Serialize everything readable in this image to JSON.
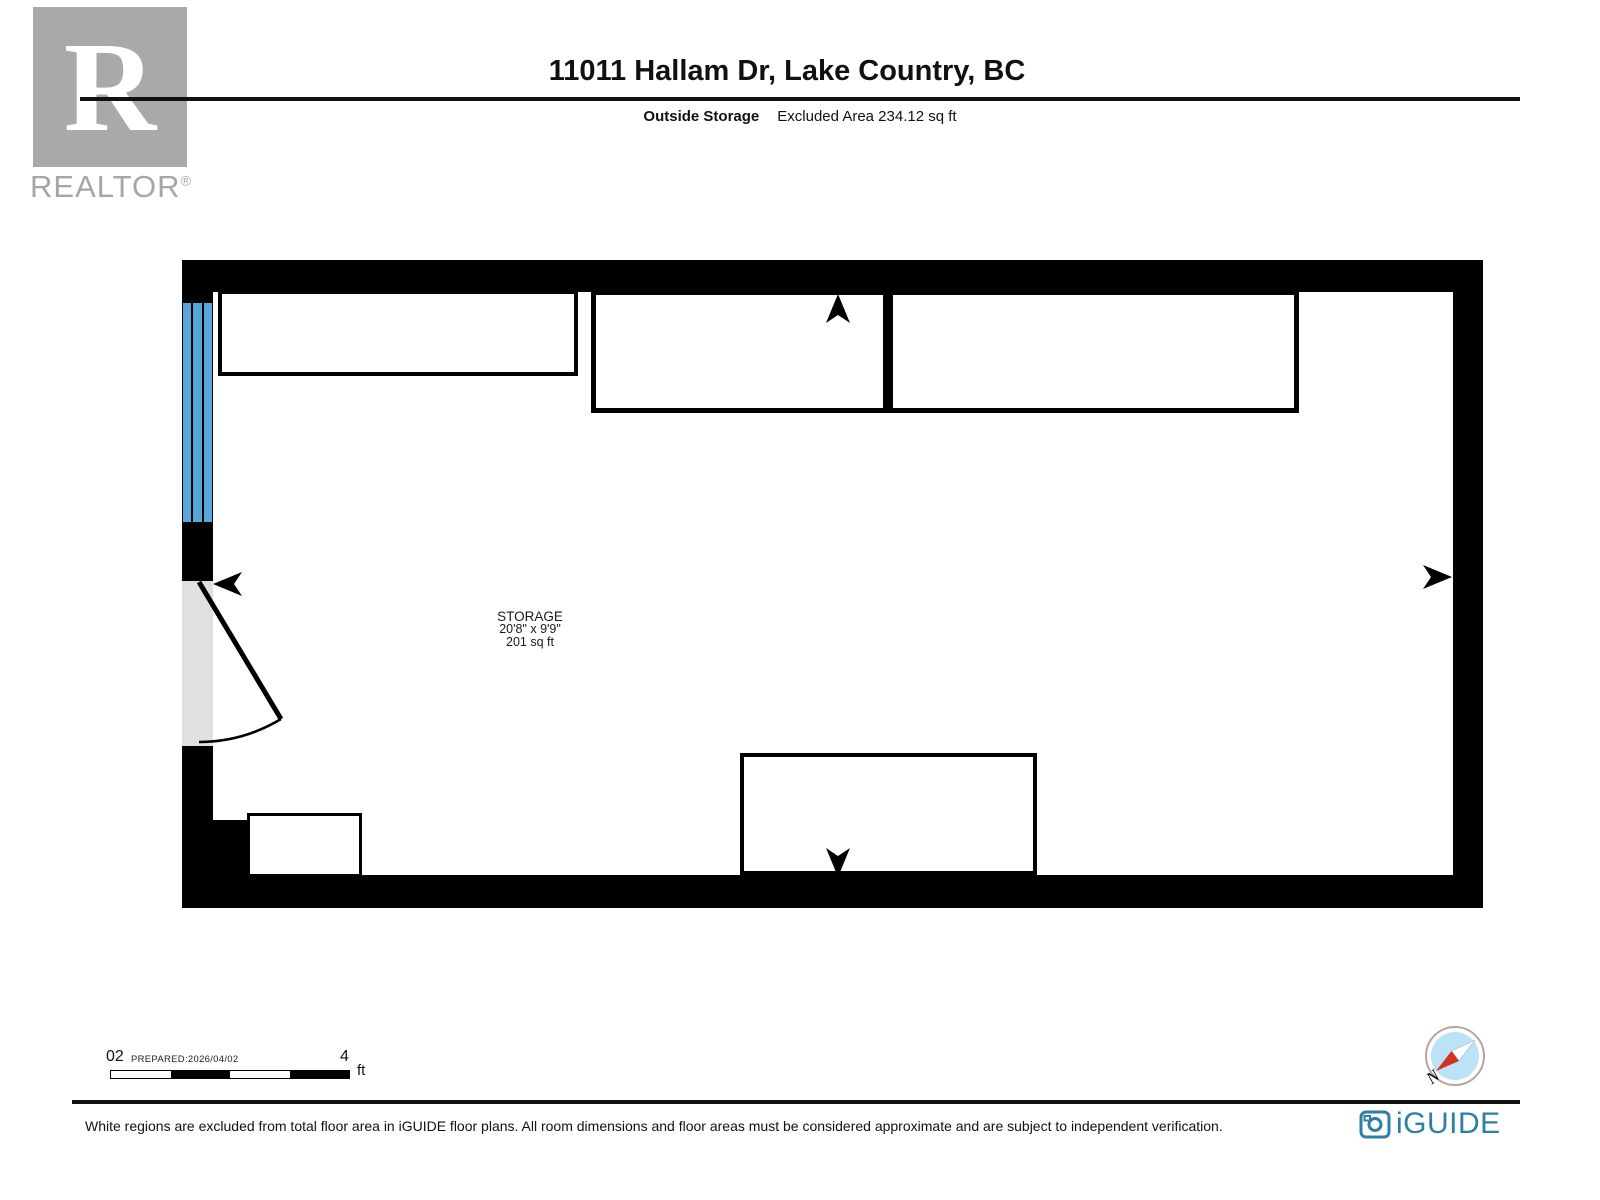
{
  "header": {
    "logo": {
      "letter": "R",
      "wordmark": "REALTOR",
      "registered_mark": "®"
    },
    "title": "11011 Hallam Dr, Lake Country, BC",
    "floor_name": "Outside Storage",
    "excluded_area": "Excluded Area 234.12 sq ft"
  },
  "floorplan": {
    "room": {
      "name": "STORAGE",
      "dimensions": "20'8\" x 9'9\"",
      "area": "201 sq ft"
    }
  },
  "scalebar": {
    "zero_label": "02",
    "prepared_label": "PREPARED:2026/04/02",
    "max_label": "4",
    "unit": "ft"
  },
  "compass": {
    "north_label": "N"
  },
  "branding": {
    "iguide": "iGUIDE"
  },
  "footer": {
    "disclaimer": "White regions are excluded from total floor area in iGUIDE floor plans. All room dimensions and floor areas must be considered approximate and are subject to independent verification."
  },
  "colors": {
    "window_blue": "#57a7db",
    "door_gray": "#e0e0e0",
    "wall_black": "#000000",
    "logo_gray": "#a9a9a9",
    "brand_blue": "#2e7ea8",
    "compass_fill_blue": "#bce2f5",
    "compass_needle_red": "#d2331f"
  }
}
